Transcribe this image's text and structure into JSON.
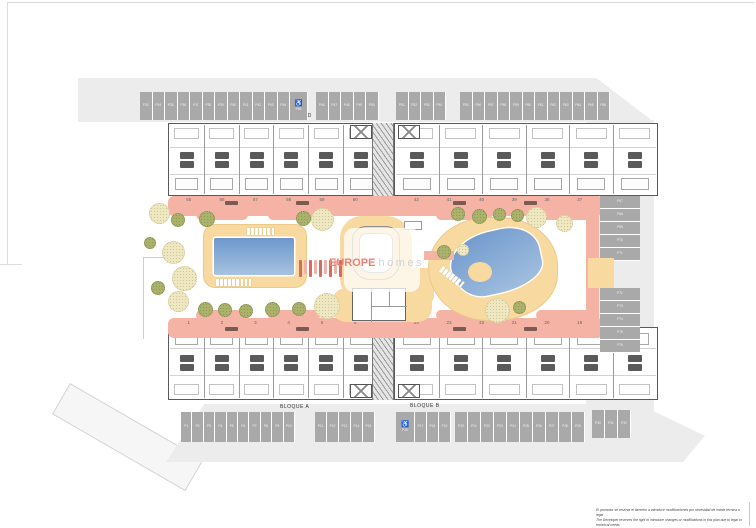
{
  "watermark": {
    "brand": "EUROPE",
    "suffix": "homes"
  },
  "blocks": [
    {
      "id": "D",
      "label": "BLOQUE D",
      "unit_numbers": [
        "55",
        "56",
        "57",
        "58",
        "59",
        "60"
      ]
    },
    {
      "id": "C",
      "label": "BLOQUE C",
      "unit_numbers": [
        "42",
        "41",
        "40",
        "39",
        "38",
        "37"
      ]
    },
    {
      "id": "A",
      "label": "BLOQUE A",
      "unit_numbers": [
        "1",
        "2",
        "3",
        "4",
        "5",
        "6"
      ]
    },
    {
      "id": "B",
      "label": "BLOQUE B",
      "unit_numbers": [
        "24",
        "23",
        "22",
        "21",
        "20",
        "19"
      ]
    }
  ],
  "parking": {
    "groups": [
      {
        "id": "pg-top-1",
        "orientation": "h",
        "stalls": [
          "P33",
          "P34",
          "P35",
          "P36",
          "P37",
          "P38",
          "P39",
          "P40",
          "P41",
          "P42",
          "P43",
          "P44"
        ],
        "handicap_last": "P45"
      },
      {
        "id": "pg-top-2",
        "orientation": "h",
        "stalls": [
          "P46",
          "P47",
          "P48",
          "P49",
          "P50"
        ]
      },
      {
        "id": "pg-top-3",
        "orientation": "h",
        "stalls": [
          "P51",
          "P52",
          "P53",
          "P54"
        ]
      },
      {
        "id": "pg-top-4",
        "orientation": "h",
        "stalls": [
          "P55",
          "P56",
          "P57",
          "P58",
          "P59",
          "P60",
          "P61",
          "P62",
          "P63",
          "P64",
          "P65",
          "P66"
        ]
      },
      {
        "id": "pg-right-top",
        "orientation": "v",
        "stalls": [
          "P67",
          "P68",
          "P69",
          "P70",
          "P71"
        ]
      },
      {
        "id": "pg-right-bottom",
        "orientation": "v",
        "stalls": [
          "P72",
          "P73",
          "P74",
          "P75",
          "P76"
        ]
      },
      {
        "id": "pg-bottom-1",
        "orientation": "h",
        "stalls": [
          "P1",
          "P2",
          "P3",
          "P4",
          "P5",
          "P6",
          "P7",
          "P8",
          "P9",
          "P10"
        ]
      },
      {
        "id": "pg-bottom-2",
        "orientation": "h",
        "stalls": [
          "P11",
          "P12",
          "P13",
          "P14",
          "P15"
        ]
      },
      {
        "id": "pg-bottom-3",
        "orientation": "h",
        "handicap_first": "P16",
        "stalls": [
          "P17",
          "P18",
          "P19"
        ]
      },
      {
        "id": "pg-bottom-4",
        "orientation": "h",
        "stalls": [
          "P20",
          "P21",
          "P22",
          "P23",
          "P24",
          "P25",
          "P26",
          "P27",
          "P28",
          "P29"
        ]
      },
      {
        "id": "pg-bottom-5",
        "orientation": "h",
        "stalls": [
          "P30",
          "P31",
          "P32"
        ]
      }
    ]
  },
  "pergola": {
    "bars": 9
  },
  "trees": [
    {
      "x": 159,
      "y": 213,
      "d": 21,
      "t": "pale"
    },
    {
      "x": 178,
      "y": 220,
      "d": 14,
      "t": "olive"
    },
    {
      "x": 150,
      "y": 243,
      "d": 12,
      "t": "olive"
    },
    {
      "x": 173,
      "y": 252,
      "d": 23,
      "t": "pale"
    },
    {
      "x": 184,
      "y": 278,
      "d": 25,
      "t": "pale"
    },
    {
      "x": 158,
      "y": 288,
      "d": 14,
      "t": "olive"
    },
    {
      "x": 178,
      "y": 301,
      "d": 21,
      "t": "pale"
    },
    {
      "x": 207,
      "y": 219,
      "d": 16,
      "t": "olive"
    },
    {
      "x": 303,
      "y": 218,
      "d": 15,
      "t": "olive"
    },
    {
      "x": 322,
      "y": 219,
      "d": 23,
      "t": "pale"
    },
    {
      "x": 205,
      "y": 309,
      "d": 15,
      "t": "olive"
    },
    {
      "x": 225,
      "y": 310,
      "d": 14,
      "t": "olive"
    },
    {
      "x": 246,
      "y": 311,
      "d": 14,
      "t": "olive"
    },
    {
      "x": 272,
      "y": 309,
      "d": 15,
      "t": "olive"
    },
    {
      "x": 299,
      "y": 309,
      "d": 14,
      "t": "olive"
    },
    {
      "x": 327,
      "y": 306,
      "d": 26,
      "t": "pale"
    },
    {
      "x": 458,
      "y": 214,
      "d": 14,
      "t": "olive"
    },
    {
      "x": 479,
      "y": 216,
      "d": 15,
      "t": "olive"
    },
    {
      "x": 499,
      "y": 214,
      "d": 13,
      "t": "olive"
    },
    {
      "x": 517,
      "y": 215,
      "d": 13,
      "t": "olive"
    },
    {
      "x": 536,
      "y": 217,
      "d": 21,
      "t": "pale"
    },
    {
      "x": 564,
      "y": 223,
      "d": 17,
      "t": "pale"
    },
    {
      "x": 444,
      "y": 252,
      "d": 14,
      "t": "olive"
    },
    {
      "x": 463,
      "y": 250,
      "d": 12,
      "t": "pale"
    },
    {
      "x": 497,
      "y": 310,
      "d": 25,
      "t": "pale"
    },
    {
      "x": 519,
      "y": 307,
      "d": 13,
      "t": "olive"
    }
  ],
  "disclaimer": {
    "line1": "El promotor se reserva el derecho a introducir modificaciones por necesidad de índole técnica o legal",
    "line2": "The Developer reserves the right to introduce changes or modifications in this plan due to legal or technical needs"
  },
  "colors": {
    "walkway": "#f4b3a5",
    "deck": "#f8d9a0",
    "pool_dark": "#6d97cc",
    "pool_light": "#a6c3e1",
    "road": "#ececec",
    "stall": "#a9a9a9",
    "brand": "#ec8275"
  }
}
